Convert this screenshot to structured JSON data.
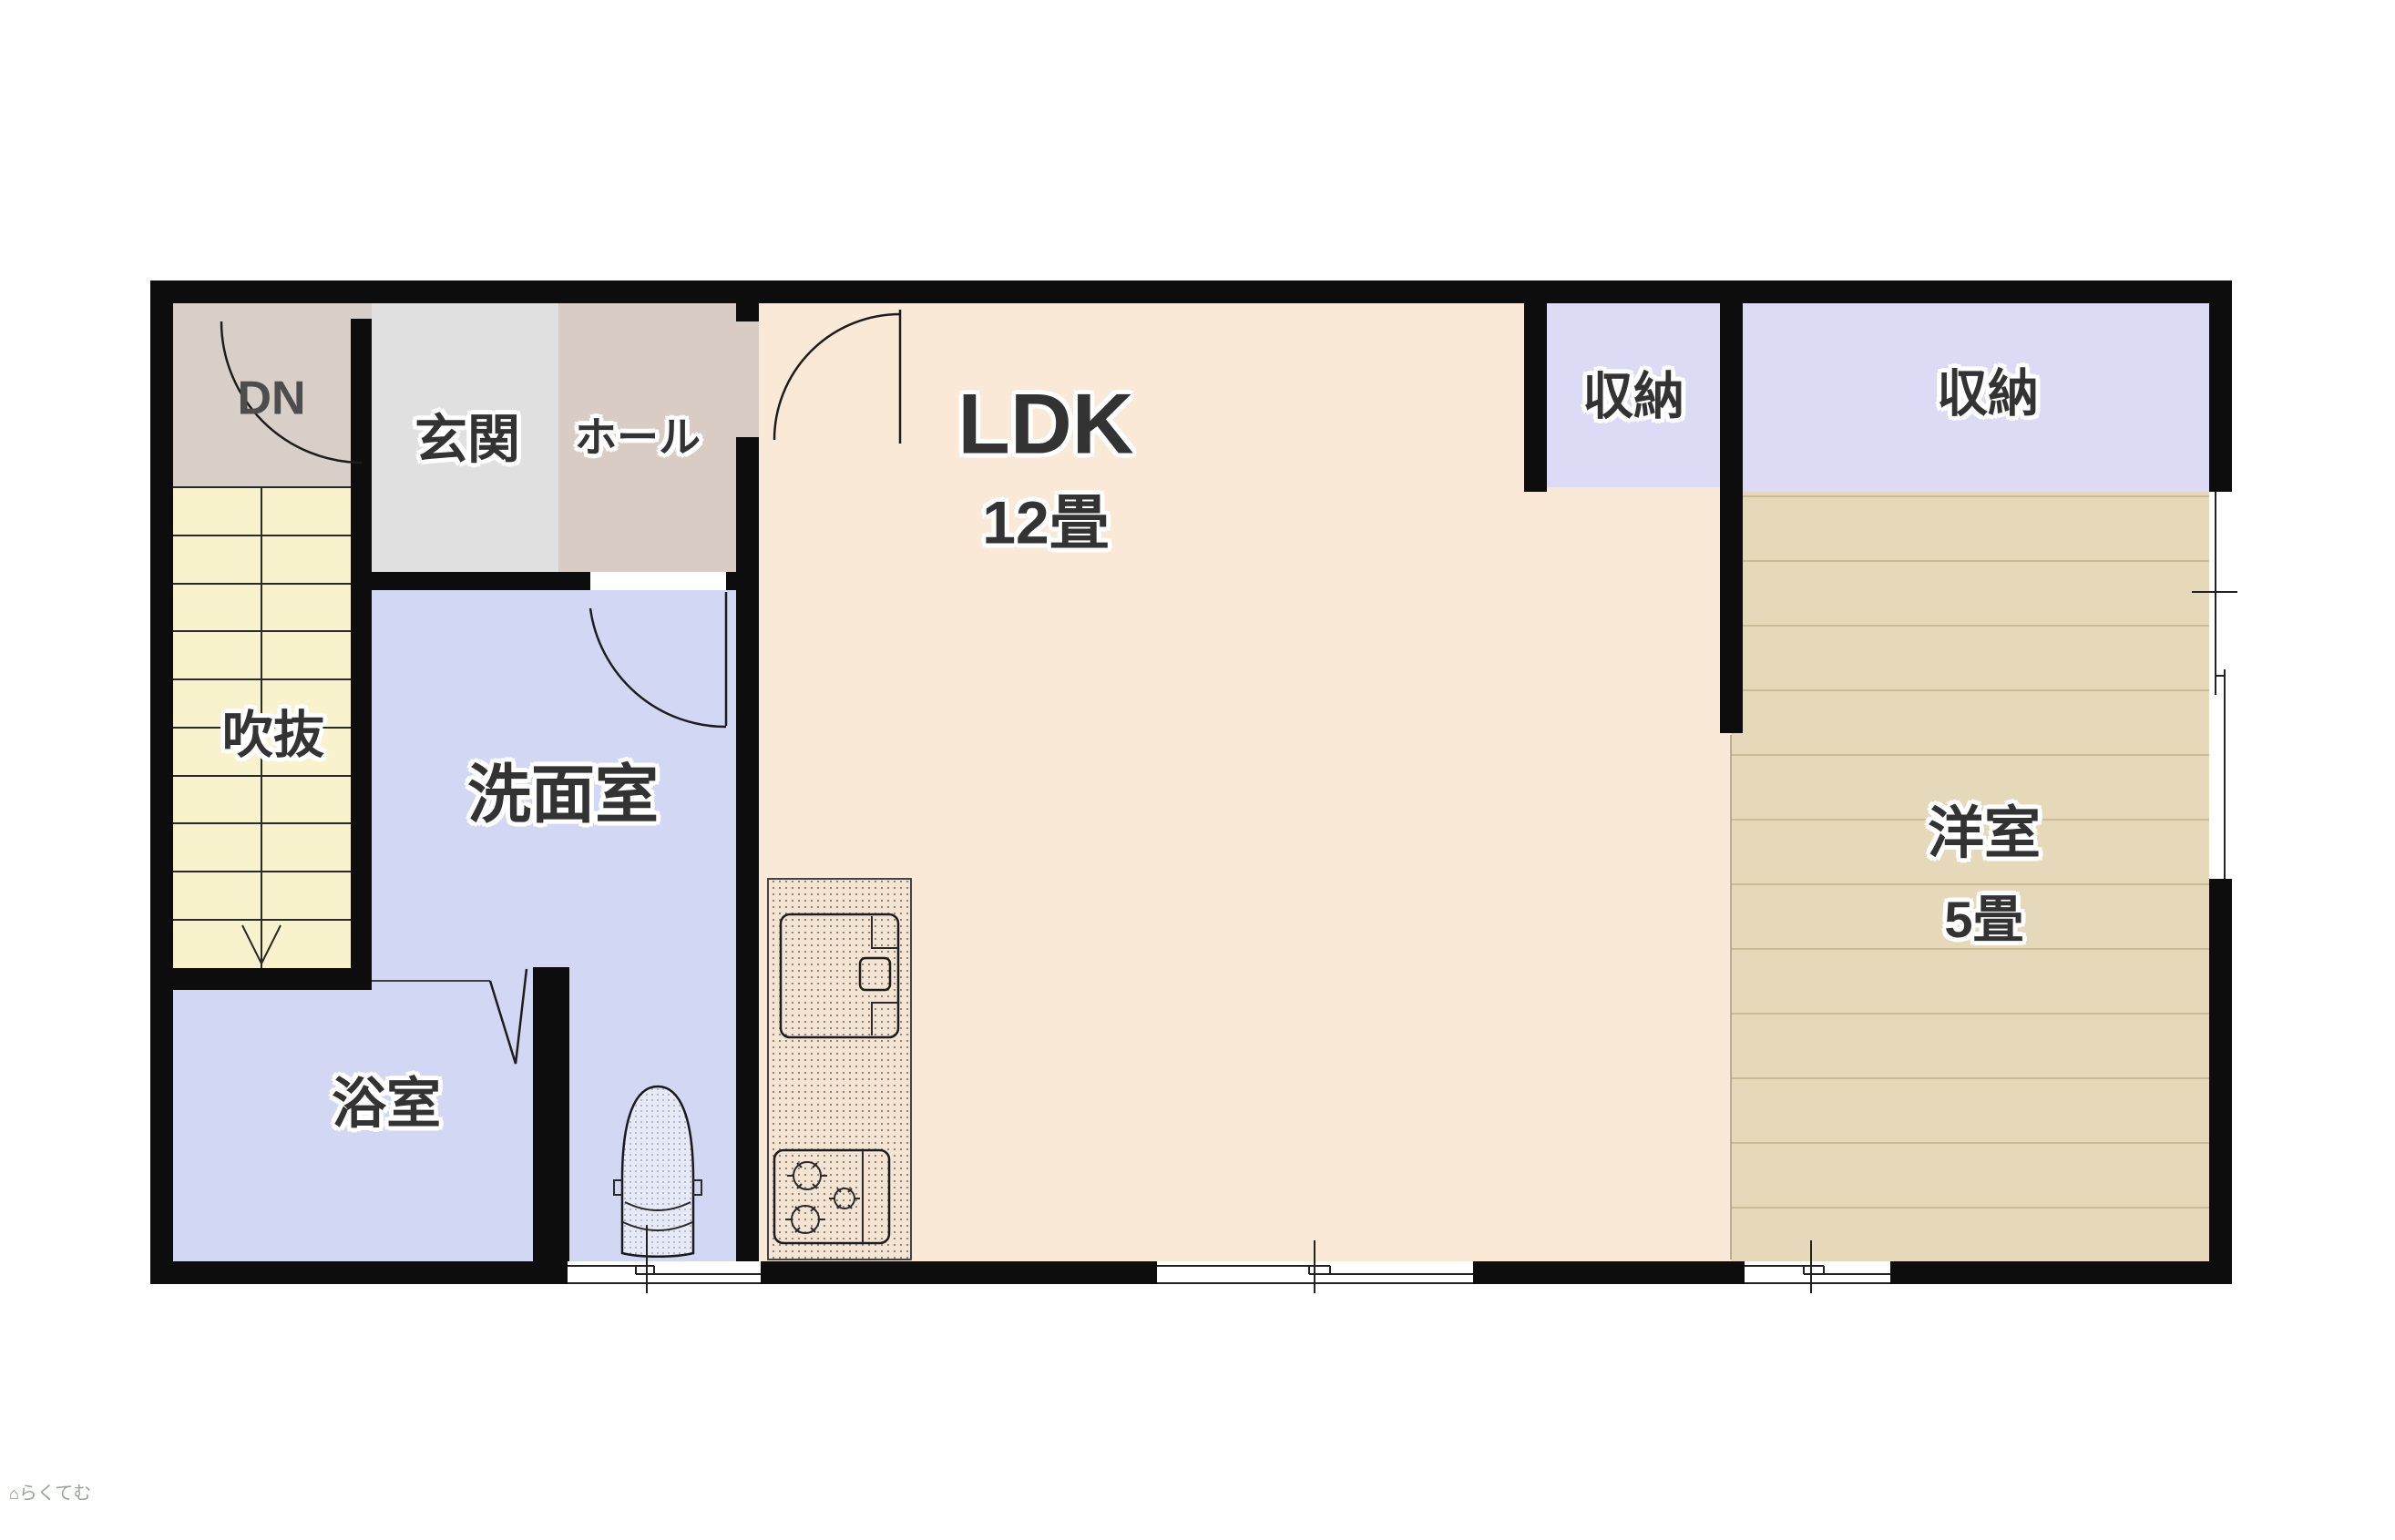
{
  "title": "2F floor plan",
  "watermark": {
    "icon": "house-icon",
    "text": "らくてむ"
  },
  "colors": {
    "wall": "#0d0d0d",
    "dn_area": "#D9CFC9",
    "entry": "#E0E0E0",
    "hall": "#D8CCC5",
    "stairs": "#F8F3CD",
    "wash": "#D2D8F3",
    "closet": "#DCDAF4",
    "ldk": "#FAE9D7",
    "western": "#E6D9B9",
    "western_line": "#CBBC97"
  },
  "rooms": {
    "dn": {
      "label": "DN"
    },
    "entry": {
      "label": "玄関"
    },
    "hall": {
      "label": "ホール"
    },
    "void": {
      "label": "吹抜"
    },
    "washroom": {
      "label": "洗面室"
    },
    "bathroom": {
      "label": "浴室"
    },
    "ldk": {
      "label": "LDK",
      "size": "12畳"
    },
    "closet1": {
      "label": "収納"
    },
    "closet2": {
      "label": "収納"
    },
    "western": {
      "label": "洋室",
      "size": "5畳"
    }
  }
}
